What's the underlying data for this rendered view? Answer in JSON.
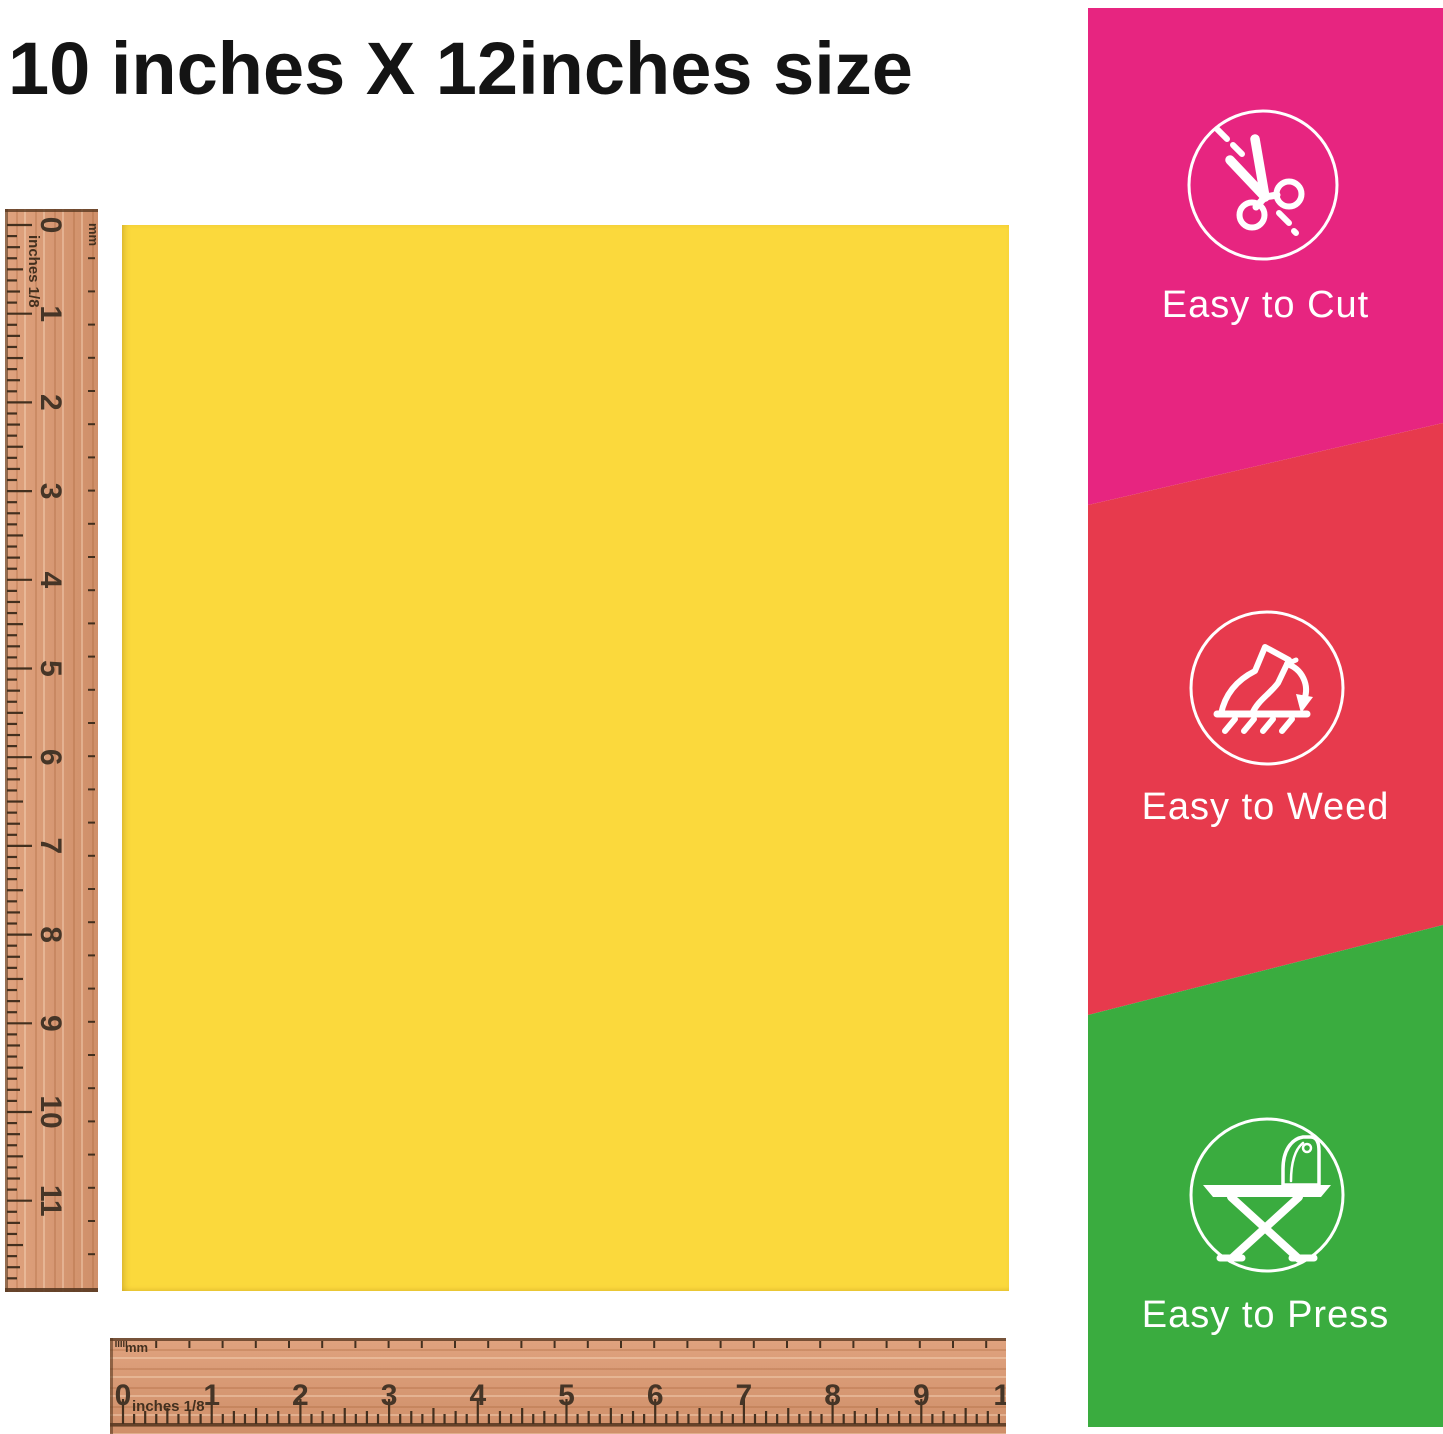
{
  "title": "10 inches X 12inches size",
  "sheet": {
    "color": "#FBD93C",
    "description": "yellow heat transfer vinyl sheet"
  },
  "rulers": {
    "wood_color": "#DC9870",
    "tick_color": "#43301F",
    "unit_label": "inches 1/8",
    "mm_label": "mm",
    "vertical_labels": [
      "0",
      "1",
      "2",
      "3",
      "4",
      "5",
      "6",
      "7",
      "8",
      "9",
      "10",
      "11"
    ],
    "horizontal_labels": [
      "0",
      "1",
      "2",
      "3",
      "4",
      "5",
      "6",
      "7",
      "8",
      "9",
      "10"
    ]
  },
  "sidebar": {
    "text_color": "#FFFFFF",
    "sections": [
      {
        "label": "Easy to Cut",
        "color": "#E72580",
        "icon": "scissors-icon"
      },
      {
        "label": "Easy to Weed",
        "color": "#E73A4D",
        "icon": "weed-peel-icon"
      },
      {
        "label": "Easy to Press",
        "color": "#3AAC3F",
        "icon": "ironing-board-icon"
      }
    ]
  }
}
